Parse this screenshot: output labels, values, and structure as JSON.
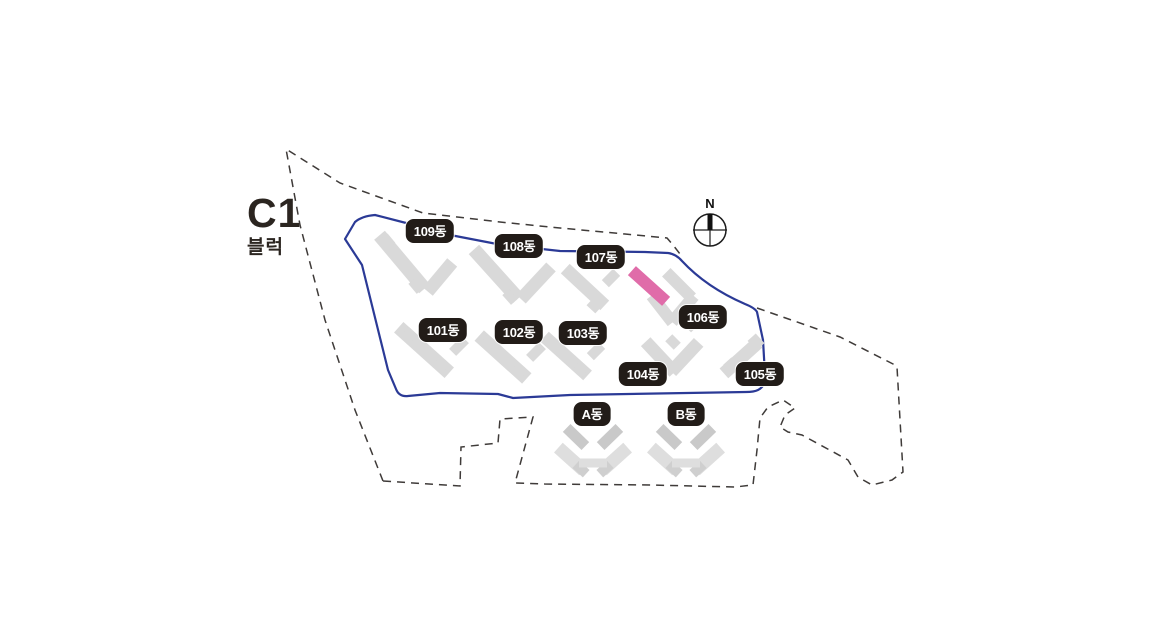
{
  "title": {
    "block_code": "C1",
    "block_suffix": "블럭"
  },
  "compass": {
    "label": "N"
  },
  "map": {
    "colors": {
      "site_boundary_blue": "#2b3a96",
      "outer_boundary_dashed": "#3f3b39",
      "building_fill": "#d9d9d9",
      "building_fill_faded": "#dedede",
      "highlight_pink": "#e06ca9",
      "chip_background": "#221c18",
      "chip_text": "#ffffff"
    },
    "chips": [
      {
        "id": "109",
        "label": "109동"
      },
      {
        "id": "108",
        "label": "108동"
      },
      {
        "id": "107",
        "label": "107동"
      },
      {
        "id": "106",
        "label": "106동"
      },
      {
        "id": "101",
        "label": "101동"
      },
      {
        "id": "102",
        "label": "102동"
      },
      {
        "id": "103",
        "label": "103동"
      },
      {
        "id": "104",
        "label": "104동"
      },
      {
        "id": "105",
        "label": "105동"
      },
      {
        "id": "A",
        "label": "A동"
      },
      {
        "id": "B",
        "label": "B동"
      }
    ]
  }
}
